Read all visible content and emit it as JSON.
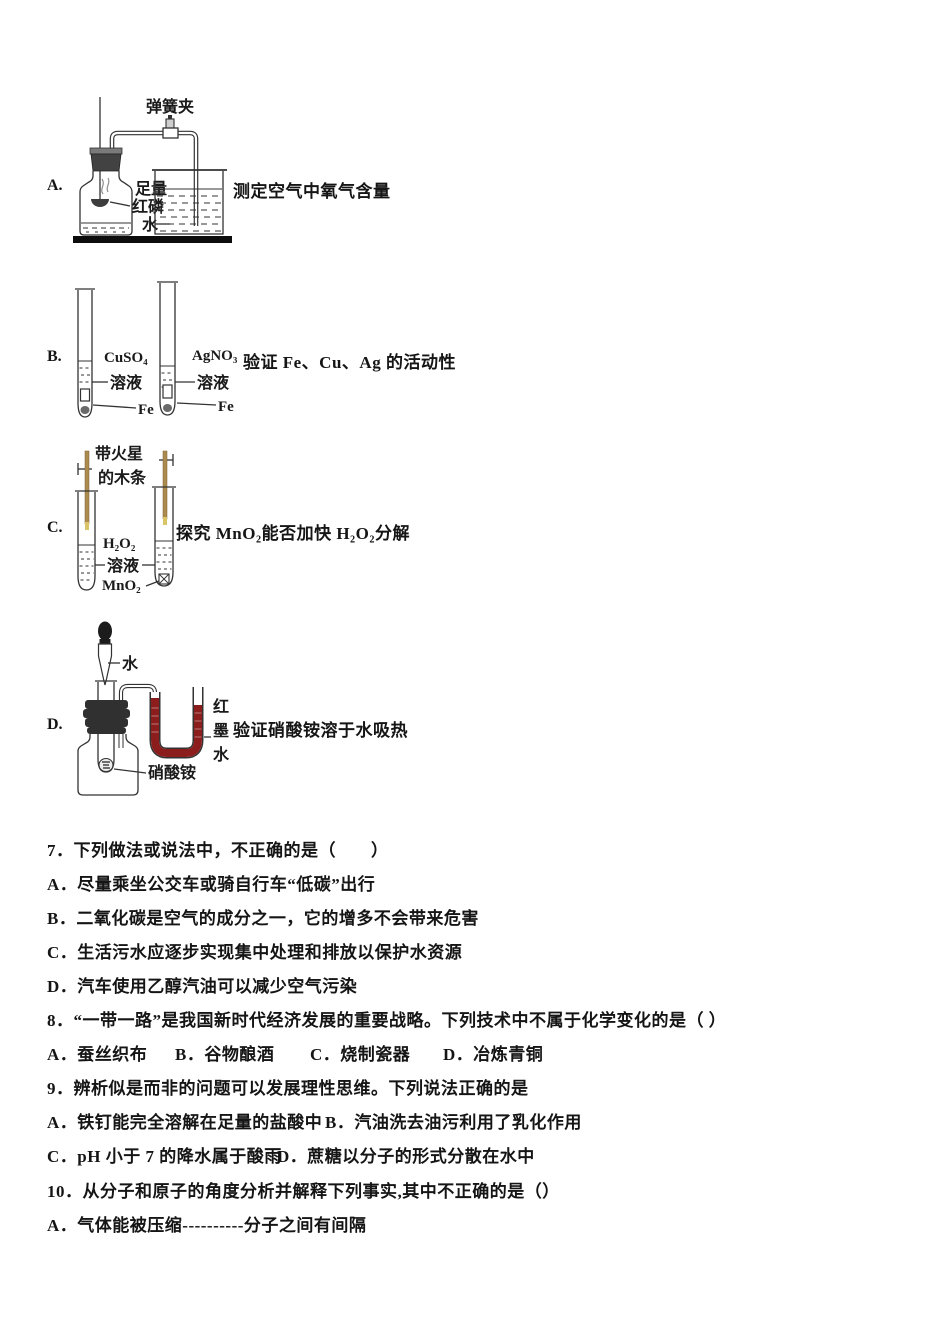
{
  "figures": [
    {
      "option": "A.",
      "caption": "测定空气中氧气含量",
      "labels": {
        "clamp": "弹簧夹",
        "l1": "足量",
        "l2": "红磷",
        "l3": "水"
      }
    },
    {
      "option": "B.",
      "caption": "验证 Fe、Cu、Ag 的活动性",
      "labels": {
        "sol1a": "CuSO₄",
        "sol1b": "溶液",
        "sol2a": "AgNO₃",
        "sol2b": "溶液",
        "fe1": "Fe",
        "fe2": "Fe"
      }
    },
    {
      "option": "C.",
      "caption": "探究 MnO₂能否加快 H₂O₂分解",
      "labels": {
        "splint1": "带火星",
        "splint2": "的木条",
        "sol1": "H₂O₂",
        "sol2": "溶液",
        "cat": "MnO₂"
      }
    },
    {
      "option": "D.",
      "caption": "验证硝酸铵溶于水吸热",
      "labels": {
        "water": "水",
        "salt": "硝酸铵",
        "ink1": "红",
        "ink2": "墨",
        "ink3": "水"
      }
    }
  ],
  "questions": {
    "q7": {
      "stem": "7．下列做法或说法中，不正确的是（　　）",
      "a": "A．尽量乘坐公交车或骑自行车“低碳”出行",
      "b": "B．二氧化碳是空气的成分之一，它的增多不会带来危害",
      "c": "C．生活污水应逐步实现集中处理和排放以保护水资源",
      "d": "D．汽车使用乙醇汽油可以减少空气污染"
    },
    "q8": {
      "stem": "8．“一带一路”是我国新时代经济发展的重要战略。下列技术中不属于化学变化的是（ ）",
      "a": "A．蚕丝织布",
      "b": "B．谷物酿酒",
      "c": "C．烧制瓷器",
      "d": "D．冶炼青铜"
    },
    "q9": {
      "stem": "9．辨析似是而非的问题可以发展理性思维。下列说法正确的是",
      "a": "A．铁钉能完全溶解在足量的盐酸中",
      "b": "B．汽油洗去油污利用了乳化作用",
      "c": "C．pH 小于 7 的降水属于酸雨",
      "d": "D．蔗糖以分子的形式分散在水中"
    },
    "q10": {
      "stem": "10．从分子和原子的角度分析并解释下列事实,其中不正确的是（）",
      "a": "A．气体能被压缩----------分子之间有间隔"
    }
  },
  "colors": {
    "red_ink": "#8b1d1d",
    "splint": "#ab8b4e",
    "splint_tip": "#d9c468",
    "stopper": "#303030"
  }
}
